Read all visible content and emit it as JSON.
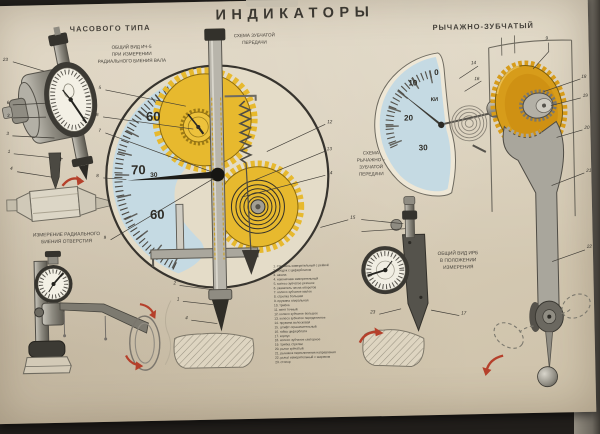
{
  "poster": {
    "title": "ИНДИКАТОРЫ"
  },
  "sections": {
    "left": {
      "heading": "ЧАСОВОГО ТИПА",
      "caption_top": "ОБЩИЙ ВИД ИЧ-5\nПРИ ИЗМЕРЕНИИ\nРАДИАЛЬНОГО БИЕНИЯ ВАЛА",
      "caption_bottom": "ИЗМЕРЕНИЕ РАДИАЛЬНОГО\nБИЕНИЯ ОТВЕРСТИЯ"
    },
    "center": {
      "scheme_label": "СХЕМА ЗУБЧАТОЙ\nПЕРЕДАЧИ",
      "dial_numbers": {
        "top": "60",
        "mid": "70",
        "mid_small": "30",
        "bottom": "60"
      }
    },
    "right": {
      "heading": "РЫЧАЖНО-ЗУБЧАТЫЙ",
      "scheme_label": "СХЕМА\nРЫЧАЖНО –\nЗУБЧАТОЙ\nПЕРЕДАЧИ",
      "caption": "ОБЩИЙ ВИД ИРБ\nВ ПОЛОЖЕНИИ\nИЗМЕРЕНИЯ",
      "dial_numbers": [
        "0",
        "10",
        "20",
        "30"
      ],
      "dial_brand": "КИ"
    }
  },
  "callouts": {
    "gauge_23": "23",
    "gauge_6": "6",
    "gauge_3a": "3",
    "gauge_3b": "3",
    "gauge_1": "1",
    "shaft_4": "4",
    "circle_5": "5",
    "circle_6": "6",
    "circle_7": "7",
    "circle_8": "8",
    "circle_9": "9",
    "circle_12": "12",
    "circle_13": "13",
    "circle_14": "14",
    "circle_15": "15",
    "rod_2": "2",
    "rod_1": "1",
    "rod_4": "4",
    "lever_9": "9",
    "lever_14": "14",
    "lever_16": "16",
    "lever_18": "18",
    "lever_19": "19",
    "lever_20": "20",
    "lever_21": "21",
    "lever_22": "22",
    "lever_17": "17",
    "lever_23": "23"
  },
  "legend": {
    "items": [
      "1. стержень измерительный с рейкой",
      "2. ободок с циферблатом",
      "3. шкала",
      "4. наконечник измерительный",
      "5. колесо зубчатое реечное",
      "6. указатель числа оборотов",
      "7. колесо зубчатое малое",
      "8. стрелка большая",
      "9. пружина спиральная",
      "10. трибка",
      "11. винт точный",
      "12. колесо зубчатое большое",
      "13. колесо зубчатое передаточное",
      "14. пружина волосковая",
      "15. штифт ограничительный",
      "16. гайка циферблата",
      "17. корпус",
      "18. колесо зубчатое секторное",
      "19. трибка стрелки",
      "20. рычаг зубчатый",
      "21. рычажок переключения направления",
      "22. рычаг измерительный с шариком",
      "23. стопор"
    ]
  },
  "colors": {
    "background": "#211e1b",
    "paper": "#d9cfbc",
    "dial_blue": "#c5dae3",
    "gear_yellow": "#e7b92e",
    "gear_gold": "#d79c1a",
    "arrow_red": "#b5402b",
    "line_dark": "#3a3733"
  }
}
